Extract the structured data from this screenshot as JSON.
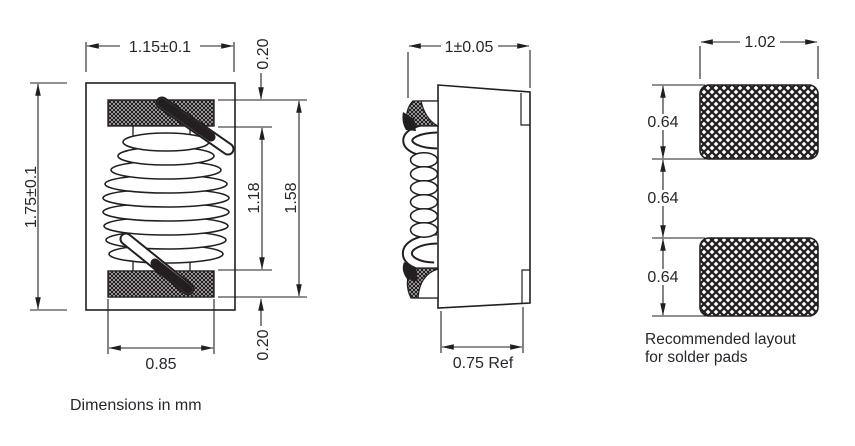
{
  "front_view": {
    "width_label": "1.15±0.1",
    "height_label": "1.75±0.1",
    "terminal_top_thickness_label": "0.20",
    "terminal_bottom_thickness_label": "0.20",
    "coil_window_label": "1.18",
    "terminal_span_label": "1.58",
    "bottom_terminal_width_label": "0.85"
  },
  "side_view": {
    "width_label": "1±0.05",
    "depth_label": "0.75 Ref"
  },
  "pad_layout": {
    "pad_width_label": "1.02",
    "pad1_height_label": "0.64",
    "gap_label": "0.64",
    "pad2_height_label": "0.64",
    "caption_line1": "Recommended layout",
    "caption_line2": "for solder pads"
  },
  "note": "Dimensions in mm",
  "colors": {
    "line": "#231f20",
    "text": "#26262c",
    "background": "#ffffff"
  }
}
